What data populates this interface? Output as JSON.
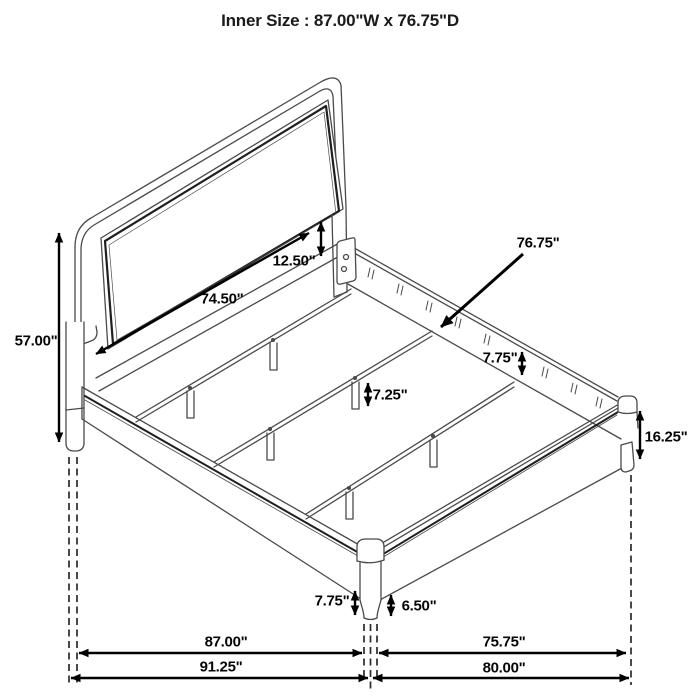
{
  "title": "Inner Size : 87.00\"W x 76.75\"D",
  "product": "bed-frame-dimension-diagram",
  "colors": {
    "background": "#ffffff",
    "frame_line": "#4a4a4a",
    "accent_line": "#1f1f1f",
    "dimension_line": "#000000",
    "label_text": "#050505"
  },
  "dimensions": {
    "headboard_inner_width": "74.50\"",
    "headboard_panel_to_rail": "12.50\"",
    "inner_depth": "76.75\"",
    "headboard_height": "57.00\"",
    "side_rail_height": "7.75\"",
    "slat_leg_height": "7.25\"",
    "footboard_rail_height": "16.25\"",
    "front_leg_height": "7.75\"",
    "front_leg_exposed": "6.50\"",
    "inner_width_floor": "87.00\"",
    "side_inner_depth_floor": "75.75\"",
    "outer_width_floor": "91.25\"",
    "outer_depth_floor": "80.00\""
  }
}
